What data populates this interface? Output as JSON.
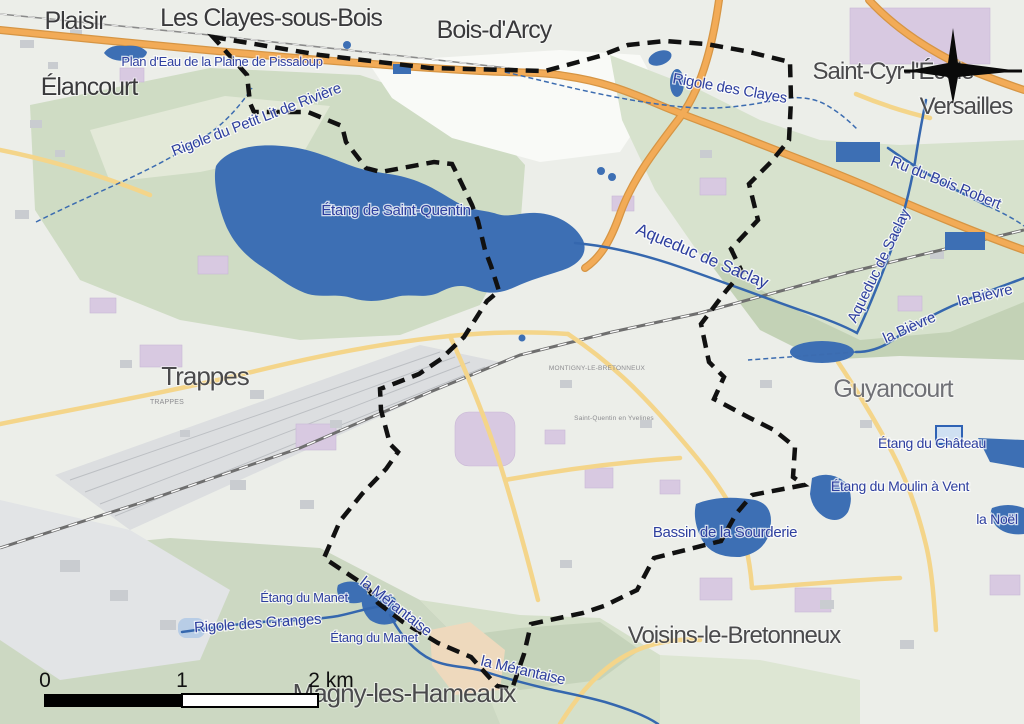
{
  "map": {
    "region_description": "Topographic street map of Saint-Quentin-en-Yvelines (commune boundary dashed) and surrounding towns",
    "colors": {
      "water": "#3d6fb4",
      "water_label": "#2e3f9f",
      "city_label": "#4a4a4c",
      "boundary": "#111111",
      "motorway": "#f2ab57",
      "secondary_road": "#f4d58a",
      "forest_green": "#cfdcc4",
      "urban_base": "#eceee9",
      "institutional_purple": "#d8c9e1"
    },
    "labels": {
      "cities": [
        {
          "text": "Plaisir",
          "x": 75,
          "y": 29
        },
        {
          "text": "Les Clayes-sous-Bois",
          "x": 271,
          "y": 26
        },
        {
          "text": "Bois-d'Arcy",
          "x": 494,
          "y": 38
        },
        {
          "text": "Saint-Cyr-l'École",
          "x": 893,
          "y": 79
        },
        {
          "text": "Versailles",
          "x": 966,
          "y": 114
        },
        {
          "text": "Élancourt",
          "x": 89,
          "y": 95
        },
        {
          "text": "Trappes",
          "x": 205,
          "y": 385
        },
        {
          "text": "Guyancourt",
          "x": 893,
          "y": 397
        },
        {
          "text": "Voisins-le-Bretonneux",
          "x": 734,
          "y": 643
        },
        {
          "text": "Magny-les-Hameaux",
          "x": 404,
          "y": 702
        }
      ],
      "water": [
        {
          "text": "Plan d'Eau de la Plaine de Pissaloup",
          "x": 222,
          "y": 66,
          "rotate": 0
        },
        {
          "text": "Rigole du Petit Lit de Rivière",
          "x": 258,
          "y": 124,
          "rotate": -21
        },
        {
          "text": "Étang de Saint-Quentin",
          "x": 396,
          "y": 215,
          "rotate": 0
        },
        {
          "text": "Rigole des Clayes",
          "x": 729,
          "y": 93,
          "rotate": 10
        },
        {
          "text": "Ru du Bois Robert",
          "x": 944,
          "y": 187,
          "rotate": 22
        },
        {
          "text": "Aqueduc de Saclay",
          "x": 883,
          "y": 268,
          "rotate": -64
        },
        {
          "text": "Aqueduc de Saclay",
          "x": 700,
          "y": 261,
          "rotate": 23
        },
        {
          "text": "la Bièvre",
          "x": 911,
          "y": 332,
          "rotate": -24
        },
        {
          "text": "la Bièvre",
          "x": 986,
          "y": 300,
          "rotate": -13
        },
        {
          "text": "Étang du Château",
          "x": 932,
          "y": 448,
          "rotate": 0
        },
        {
          "text": "Étang du Moulin à Vent",
          "x": 900,
          "y": 491,
          "rotate": 0
        },
        {
          "text": "la Noël",
          "x": 997,
          "y": 524,
          "rotate": 0
        },
        {
          "text": "Bassin de la Sourderie",
          "x": 725,
          "y": 537,
          "rotate": 0
        },
        {
          "text": "Étang du Manet",
          "x": 304,
          "y": 602,
          "rotate": 0
        },
        {
          "text": "Étang du Manet",
          "x": 374,
          "y": 642,
          "rotate": 0
        },
        {
          "text": "Rigole des Granges",
          "x": 258,
          "y": 628,
          "rotate": -4
        },
        {
          "text": "la Mérantaise",
          "x": 393,
          "y": 610,
          "rotate": 38
        },
        {
          "text": "la Mérantaise",
          "x": 522,
          "y": 675,
          "rotate": 13
        }
      ],
      "minor": [
        {
          "text": "MONTIGNY-LE-BRETONNEUX",
          "x": 597,
          "y": 370
        },
        {
          "text": "Saint-Quentin en Yvelines",
          "x": 614,
          "y": 420
        },
        {
          "text": "TRAPPES",
          "x": 167,
          "y": 404
        }
      ]
    },
    "scale_bar": {
      "tick0": "0",
      "tick1": "1",
      "tick2": "2 km"
    },
    "compass": {
      "name": "north-compass-rose"
    }
  }
}
